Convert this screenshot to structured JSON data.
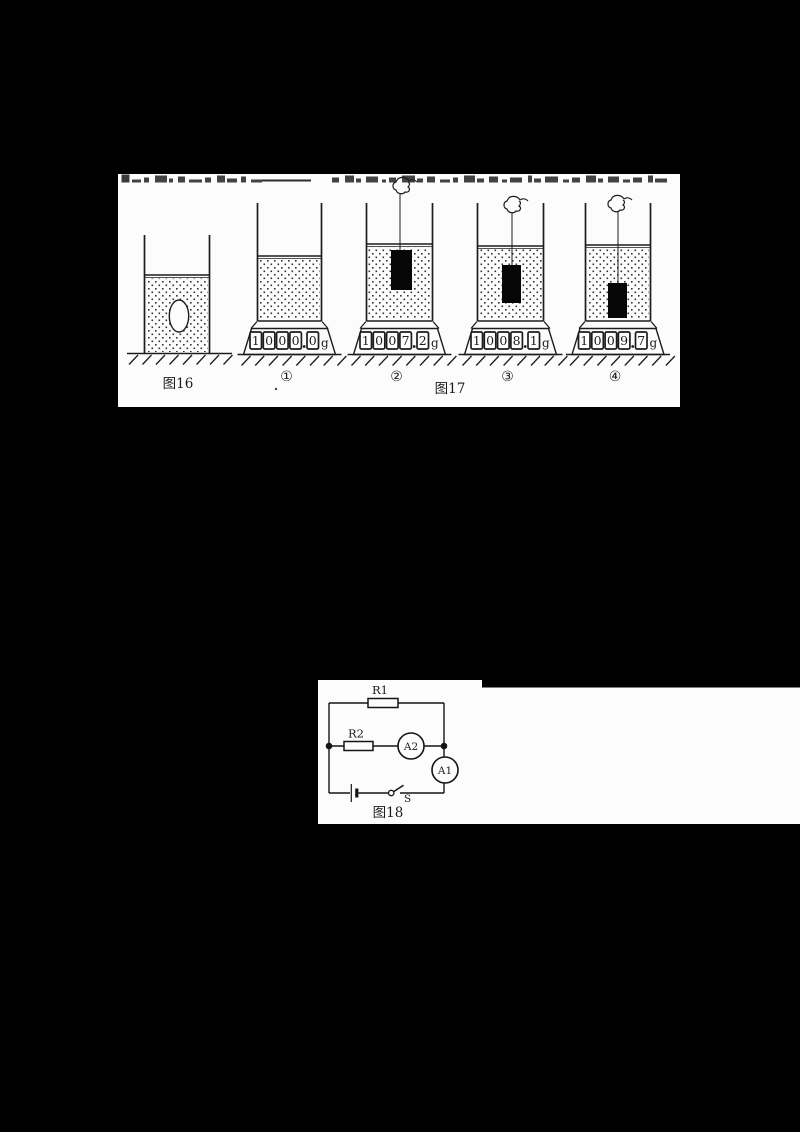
{
  "page": {
    "background_color": "#000000",
    "paper_color": "#fcfcfc",
    "ink_color": "#1c1c1c"
  },
  "figure16": {
    "label": "图16"
  },
  "figure17": {
    "label": "图17",
    "unit": "g",
    "beakers": [
      {
        "index": "①",
        "reading": "1000.0"
      },
      {
        "index": "②",
        "reading": "1007.2"
      },
      {
        "index": "③",
        "reading": "1008.1"
      },
      {
        "index": "④",
        "reading": "1009.7"
      }
    ]
  },
  "figure18": {
    "label": "图18",
    "resistor1_label": "R1",
    "resistor2_label": "R2",
    "ammeter1_label": "A1",
    "ammeter2_label": "A2",
    "switch_label": "S"
  }
}
